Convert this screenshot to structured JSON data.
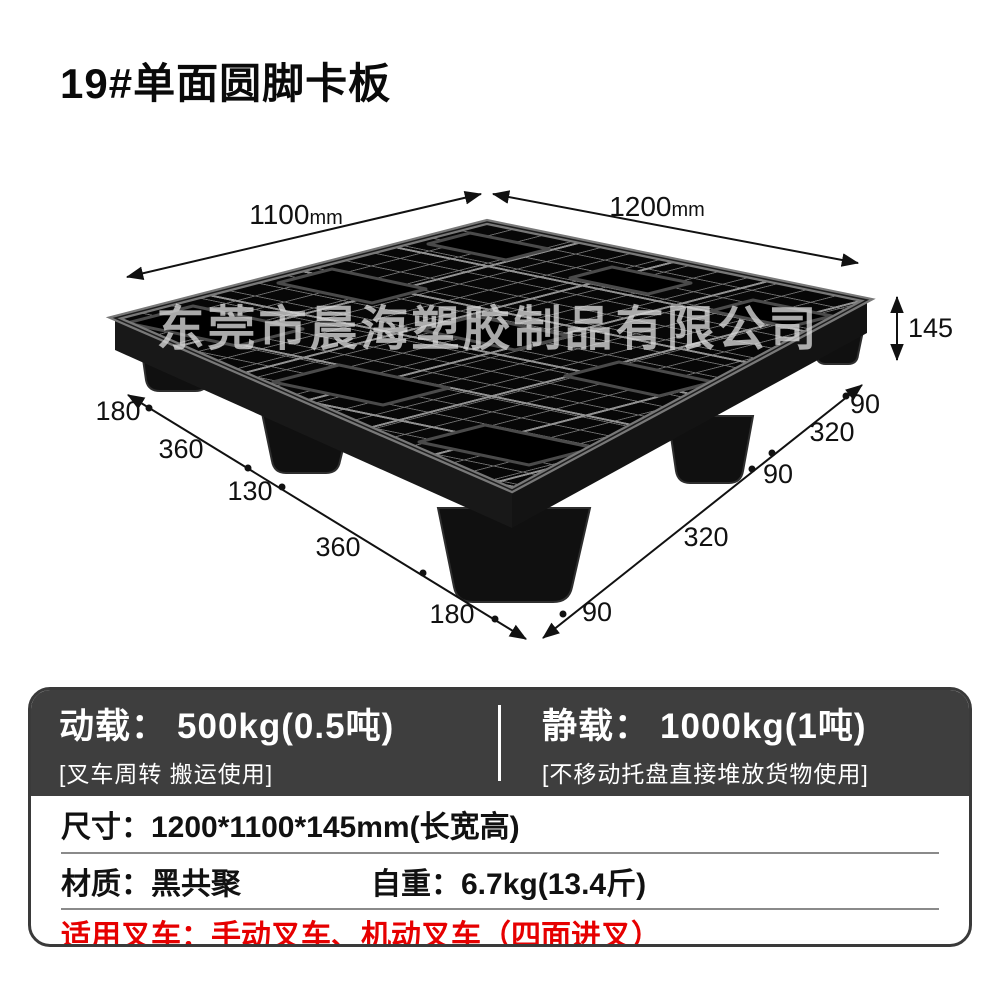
{
  "title": "19#单面圆脚卡板",
  "watermark": "东莞市晨海塑胶制品有限公司",
  "colors": {
    "header_bg": "#3e3e3e",
    "accent_red": "#e60000",
    "border": "#3a3a3a",
    "divider_gray": "#8a8a8a",
    "ink": "#111111",
    "watermark_gray": "#d9d9d9",
    "pallet_black": "#0a0a0a"
  },
  "dims": {
    "top_left_num": "1100",
    "top_left_unit": "mm",
    "top_right_num": "1200",
    "top_right_unit": "mm",
    "height": "145",
    "left_segs": [
      "180",
      "360",
      "130",
      "360",
      "180"
    ],
    "right_segs": [
      "90",
      "320",
      "90",
      "320",
      "90"
    ]
  },
  "specs": {
    "dynamic_load": {
      "label": "动载：",
      "value": "500kg(0.5吨)",
      "note": "[叉车周转 搬运使用]"
    },
    "static_load": {
      "label": "静载：",
      "value": "1000kg(1吨)",
      "note": "[不移动托盘直接堆放货物使用]"
    },
    "size": {
      "label": "尺寸：",
      "value": "1200*1100*145mm(长宽高)"
    },
    "material": {
      "label": "材质：",
      "value": "黑共聚"
    },
    "weight": {
      "label": "自重：",
      "value": "6.7kg(13.4斤)"
    },
    "forklift": {
      "label": "适用叉车：",
      "value": "手动叉车、机动叉车（四面进叉）"
    }
  }
}
